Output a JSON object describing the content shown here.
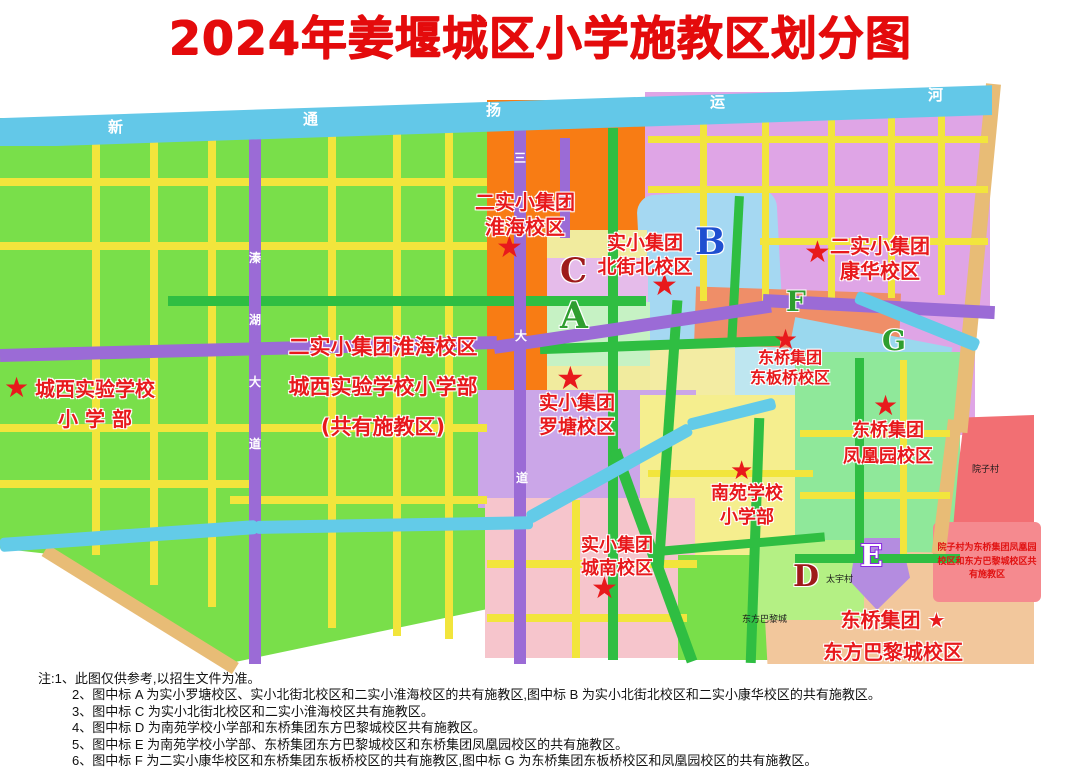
{
  "title": "2024年姜堰城区小学施教区划分图",
  "icons": {
    "star": "★"
  },
  "river": {
    "name": "新通扬运河",
    "chars": [
      "新",
      "通",
      "扬",
      "运",
      "河"
    ]
  },
  "roads": {
    "qinhu_avenue_chars": [
      "溱",
      "湖",
      "大",
      "道"
    ],
    "sanshui_avenue_chars": [
      "三",
      "大",
      "道"
    ]
  },
  "letters": [
    "A",
    "B",
    "C",
    "D",
    "E",
    "F",
    "G"
  ],
  "schools": [
    {
      "id": "huaihai-north",
      "lines": [
        "二实小集团",
        "淮海校区"
      ]
    },
    {
      "id": "beijiebei",
      "lines": [
        "实小集团",
        "北街北校区"
      ]
    },
    {
      "id": "kanghua",
      "lines": [
        "二实小集团",
        "康华校区"
      ]
    },
    {
      "id": "shared-west",
      "lines": [
        "二实小集团淮海校区",
        "城西实验学校小学部",
        "(共有施教区)"
      ]
    },
    {
      "id": "chengxi",
      "lines": [
        "城西实验学校",
        "小 学 部"
      ]
    },
    {
      "id": "luotang",
      "lines": [
        "实小集团",
        "罗塘校区"
      ]
    },
    {
      "id": "dongbanqiao",
      "lines": [
        "东桥集团",
        "东板桥校区"
      ]
    },
    {
      "id": "fenghuangyuan",
      "lines": [
        "东桥集团",
        "凤凰园校区"
      ]
    },
    {
      "id": "nanyuan",
      "lines": [
        "南苑学校",
        "小学部"
      ]
    },
    {
      "id": "chengnan",
      "lines": [
        "实小集团",
        "城南校区"
      ]
    },
    {
      "id": "dongfangbalicheng",
      "lines": [
        "东桥集团 ★",
        "东方巴黎城校区"
      ]
    }
  ],
  "annotations": {
    "yuanzi_note": "院子村为东桥集团凤凰园校区和东方巴黎城校区共有施教区",
    "villages": [
      "太宇村",
      "院子村",
      "东方巴黎城"
    ]
  },
  "notes": {
    "prefix": "注:",
    "items": [
      "1、此图仅供参考,以招生文件为准。",
      "2、图中标 A 为实小罗塘校区、实小北街北校区和二实小淮海校区的共有施教区,图中标 B 为实小北街北校区和二实小康华校区的共有施教区。",
      "3、图中标 C 为实小北街北校区和二实小淮海校区共有施教区。",
      "4、图中标 D 为南苑学校小学部和东桥集团东方巴黎城校区共有施教区。",
      "5、图中标 E 为南苑学校小学部、东桥集团东方巴黎城校区和东桥集团凤凰园校区的共有施教区。",
      "6、图中标 F 为二实小康华校区和东桥集团东板桥校区的共有施教区,图中标 G 为东桥集团东板桥校区和凤凰园校区的共有施教区。"
    ]
  },
  "colors": {
    "title_red": "#e40b0c",
    "label_red": "#e8191c",
    "river_blue": "#63c8e8",
    "road_yellow": "#f2e53c",
    "road_green": "#2fbe42",
    "road_purple": "#9b6bd6",
    "zone_green": "#79df4a",
    "zone_orange": "#f87c14",
    "zone_violet": "#dfa5e6",
    "zone_blue": "#a5d8f2",
    "zone_pink": "#f6c5cc",
    "zone_yellow": "#f5ee8e",
    "zone_salmon": "#ef8e68",
    "zone_tan": "#f2c79c",
    "zone_red": "#f26f73"
  }
}
